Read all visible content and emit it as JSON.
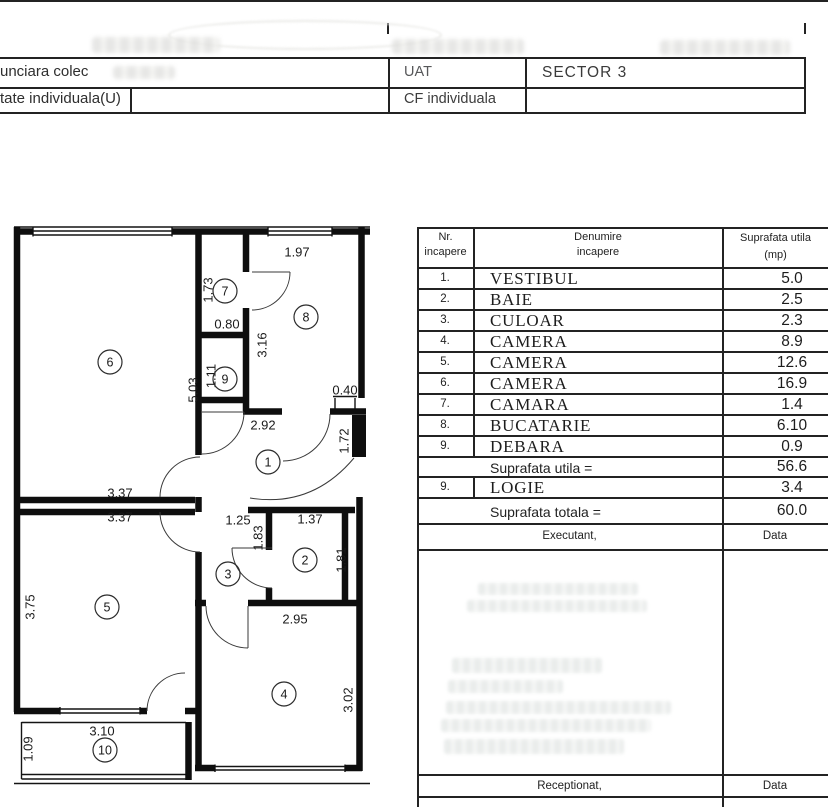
{
  "header": {
    "row1_left_fragment": "unciara colec",
    "row1_col_label": "UAT",
    "row1_col_value": "SECTOR 3",
    "row2_left_fragment": "tate individuala(U)",
    "row2_col_label": "CF individuala"
  },
  "table": {
    "col1_line1": "Nr.",
    "col1_line2": "incapere",
    "col2_line1": "Denumire",
    "col2_line2": "incapere",
    "col3_line1": "Suprafata utila",
    "col3_line2": "(mp)",
    "rows": [
      {
        "nr": "1.",
        "name": "VESTIBUL",
        "area": "5.0"
      },
      {
        "nr": "2.",
        "name": "BAIE",
        "area": "2.5"
      },
      {
        "nr": "3.",
        "name": "CULOAR",
        "area": "2.3"
      },
      {
        "nr": "4.",
        "name": "CAMERA",
        "area": "8.9"
      },
      {
        "nr": "5.",
        "name": "CAMERA",
        "area": "12.6"
      },
      {
        "nr": "6.",
        "name": "CAMERA",
        "area": "16.9"
      },
      {
        "nr": "7.",
        "name": "CAMARA",
        "area": "1.4"
      },
      {
        "nr": "8.",
        "name": "BUCATARIE",
        "area": "6.10"
      },
      {
        "nr": "9.",
        "name": "DEBARA",
        "area": "0.9"
      }
    ],
    "subtotal_label": "Suprafata utila =",
    "subtotal_value": "56.6",
    "logie_row": {
      "nr": "9.",
      "name": "LOGIE",
      "area": "3.4"
    },
    "total_label": "Suprafata totala =",
    "total_value": "60.0",
    "executant_label": "Executant,",
    "executant_data_label": "Data",
    "receptionat_label": "Receptionat,",
    "receptionat_data_label": "Data"
  },
  "plan": {
    "rooms": [
      {
        "n": "1",
        "x": 268,
        "y": 462
      },
      {
        "n": "2",
        "x": 305,
        "y": 560
      },
      {
        "n": "3",
        "x": 228,
        "y": 574
      },
      {
        "n": "4",
        "x": 284,
        "y": 694
      },
      {
        "n": "5",
        "x": 107,
        "y": 607
      },
      {
        "n": "6",
        "x": 110,
        "y": 362
      },
      {
        "n": "7",
        "x": 225,
        "y": 291
      },
      {
        "n": "8",
        "x": 306,
        "y": 317
      },
      {
        "n": "9",
        "x": 225,
        "y": 379
      },
      {
        "n": "10",
        "x": 105,
        "y": 750
      }
    ],
    "dimensions": [
      {
        "t": "1.97",
        "x": 297,
        "y": 252,
        "r": 0
      },
      {
        "t": "1.73",
        "x": 208,
        "y": 290,
        "r": 1
      },
      {
        "t": "0.80",
        "x": 227,
        "y": 324,
        "r": 0
      },
      {
        "t": "3.16",
        "x": 262,
        "y": 345,
        "r": 1
      },
      {
        "t": "1.11",
        "x": 211,
        "y": 376,
        "r": 1
      },
      {
        "t": "5.03",
        "x": 193,
        "y": 390,
        "r": 1
      },
      {
        "t": "0.40",
        "x": 345,
        "y": 390,
        "r": 0
      },
      {
        "t": "2.92",
        "x": 263,
        "y": 425,
        "r": 0
      },
      {
        "t": "1.72",
        "x": 344,
        "y": 441,
        "r": 1
      },
      {
        "t": "3.37",
        "x": 120,
        "y": 493,
        "r": 0
      },
      {
        "t": "3.37",
        "x": 120,
        "y": 517,
        "r": 0
      },
      {
        "t": "1.25",
        "x": 238,
        "y": 520,
        "r": 0
      },
      {
        "t": "1.37",
        "x": 310,
        "y": 519,
        "r": 0
      },
      {
        "t": "1.83",
        "x": 258,
        "y": 538,
        "r": 1
      },
      {
        "t": "1.81",
        "x": 341,
        "y": 560,
        "r": 1
      },
      {
        "t": "3.75",
        "x": 30,
        "y": 607,
        "r": 1
      },
      {
        "t": "2.95",
        "x": 295,
        "y": 619,
        "r": 0
      },
      {
        "t": "3.02",
        "x": 348,
        "y": 700,
        "r": 1
      },
      {
        "t": "3.10",
        "x": 102,
        "y": 731,
        "r": 0
      },
      {
        "t": "1.09",
        "x": 28,
        "y": 749,
        "r": 1
      }
    ]
  }
}
